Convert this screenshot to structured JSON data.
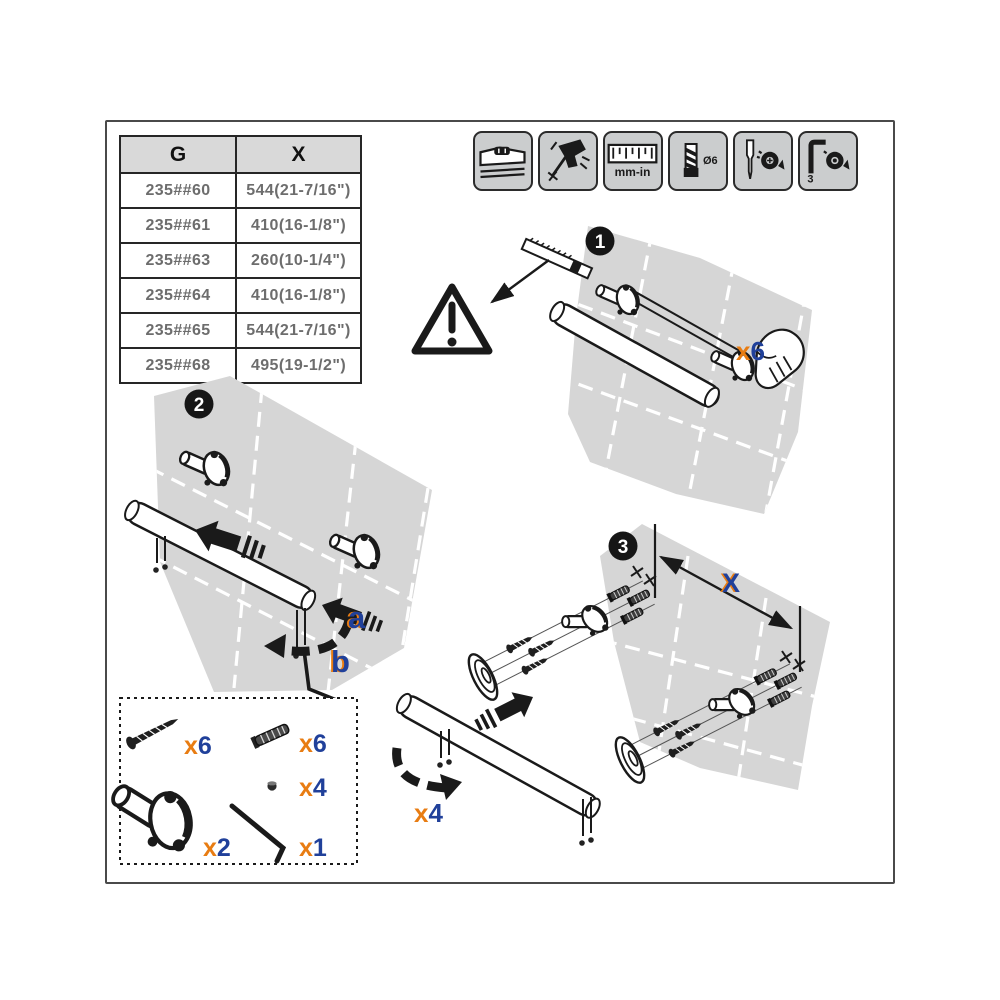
{
  "colors": {
    "orange": "#e87c12",
    "blue": "#20409a",
    "tile_gray": "#d6d6d6",
    "ink": "#1a1a1a",
    "tool_panel_gray": "#cbcdce"
  },
  "table": {
    "headers": [
      "G",
      "X"
    ],
    "rows": [
      {
        "g": "235##60",
        "x": "544(21-7/16\")"
      },
      {
        "g": "235##61",
        "x": "410(16-1/8\")"
      },
      {
        "g": "235##63",
        "x": "260(10-1/4\")"
      },
      {
        "g": "235##64",
        "x": "410(16-1/8\")"
      },
      {
        "g": "235##65",
        "x": "544(21-7/16\")"
      },
      {
        "g": "235##68",
        "x": "495(19-1/2\")"
      }
    ]
  },
  "tools": {
    "icons": [
      {
        "name": "spirit-level-icon",
        "label": ""
      },
      {
        "name": "power-drill-icon",
        "label": ""
      },
      {
        "name": "ruler-icon",
        "label": "mm-in"
      },
      {
        "name": "drill-bit-icon",
        "label": "Ø6"
      },
      {
        "name": "screwdriver-icon",
        "label": ""
      },
      {
        "name": "hex-key-icon",
        "label": "3"
      }
    ]
  },
  "steps": {
    "step1": {
      "number": "1",
      "qty_prefix": "x",
      "qty_count": "6"
    },
    "step2": {
      "number": "2",
      "label_a": "a",
      "label_b": "b"
    },
    "step3": {
      "number": "3",
      "dimension_label": "X",
      "qty_prefix": "x",
      "qty_count": "4"
    }
  },
  "parts_box": {
    "items": [
      {
        "name": "mounting-screw",
        "qty_prefix": "x",
        "qty_count": "6"
      },
      {
        "name": "wall-plug",
        "qty_prefix": "x",
        "qty_count": "6"
      },
      {
        "name": "set-screw",
        "qty_prefix": "x",
        "qty_count": "4"
      },
      {
        "name": "wall-bracket",
        "qty_prefix": "x",
        "qty_count": "2"
      },
      {
        "name": "hex-key",
        "qty_prefix": "x",
        "qty_count": "1"
      }
    ]
  }
}
